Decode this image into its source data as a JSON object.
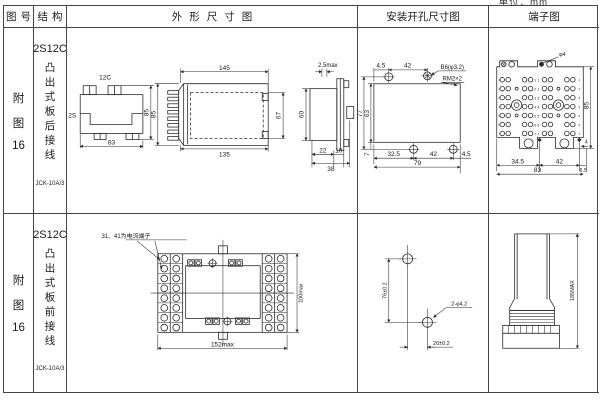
{
  "page": {
    "unit_label": "单位：mm"
  },
  "header": {
    "fig": "图号",
    "structure": "结构",
    "outline": "外形尺寸图",
    "mounting": "安装开孔尺寸图",
    "terminal": "端子图"
  },
  "rows": [
    {
      "fig": {
        "a": "附",
        "b": "图",
        "c": "16"
      },
      "structure": {
        "model": "2S12C",
        "type": "凸出式板后接线",
        "code": "JCK-10A/3"
      },
      "outline": {
        "top_view": {
          "t12c": "12C",
          "t2s": "2S",
          "h": "85",
          "w": "83"
        },
        "side_view": {
          "top": "145",
          "bottom": "135",
          "left": "85",
          "right": "67"
        },
        "section": {
          "top": "2.5max",
          "left": "60",
          "b1": "22",
          "b2": "10",
          "b3": "38"
        }
      },
      "mounting": {
        "t1": "4.5",
        "t2": "42",
        "hole": "B6(φ3.2)",
        "thread": "RM2×2",
        "l1": "77",
        "l2": "63",
        "l3": "7",
        "b1": "32.5",
        "b2": "42",
        "b3": "4.5",
        "b4": "79"
      },
      "terminal": {
        "hole": "φ4",
        "r1": "85",
        "r2": "4",
        "b1": "34.5",
        "b2": "42",
        "b3": "6.5",
        "b4": "83",
        "pairs": [
          "11",
          "22",
          "33",
          "44",
          "55",
          "66",
          "77"
        ],
        "rownums": [
          "1",
          "2",
          "3",
          "4",
          "5",
          "6",
          "7"
        ]
      }
    },
    {
      "fig": {
        "a": "附",
        "b": "图",
        "c": "16"
      },
      "structure": {
        "model": "2S12C",
        "type": "凸出式板前接线",
        "code": "JCK-10A/3"
      },
      "outline": {
        "note": "31、41为电流端子",
        "w": "152max",
        "h": "100max"
      },
      "mounting": {
        "v": "76±0.2",
        "h": "20±0.2",
        "hole": "2-φ4.2"
      },
      "terminal": {
        "h": "185MAX"
      }
    }
  ]
}
